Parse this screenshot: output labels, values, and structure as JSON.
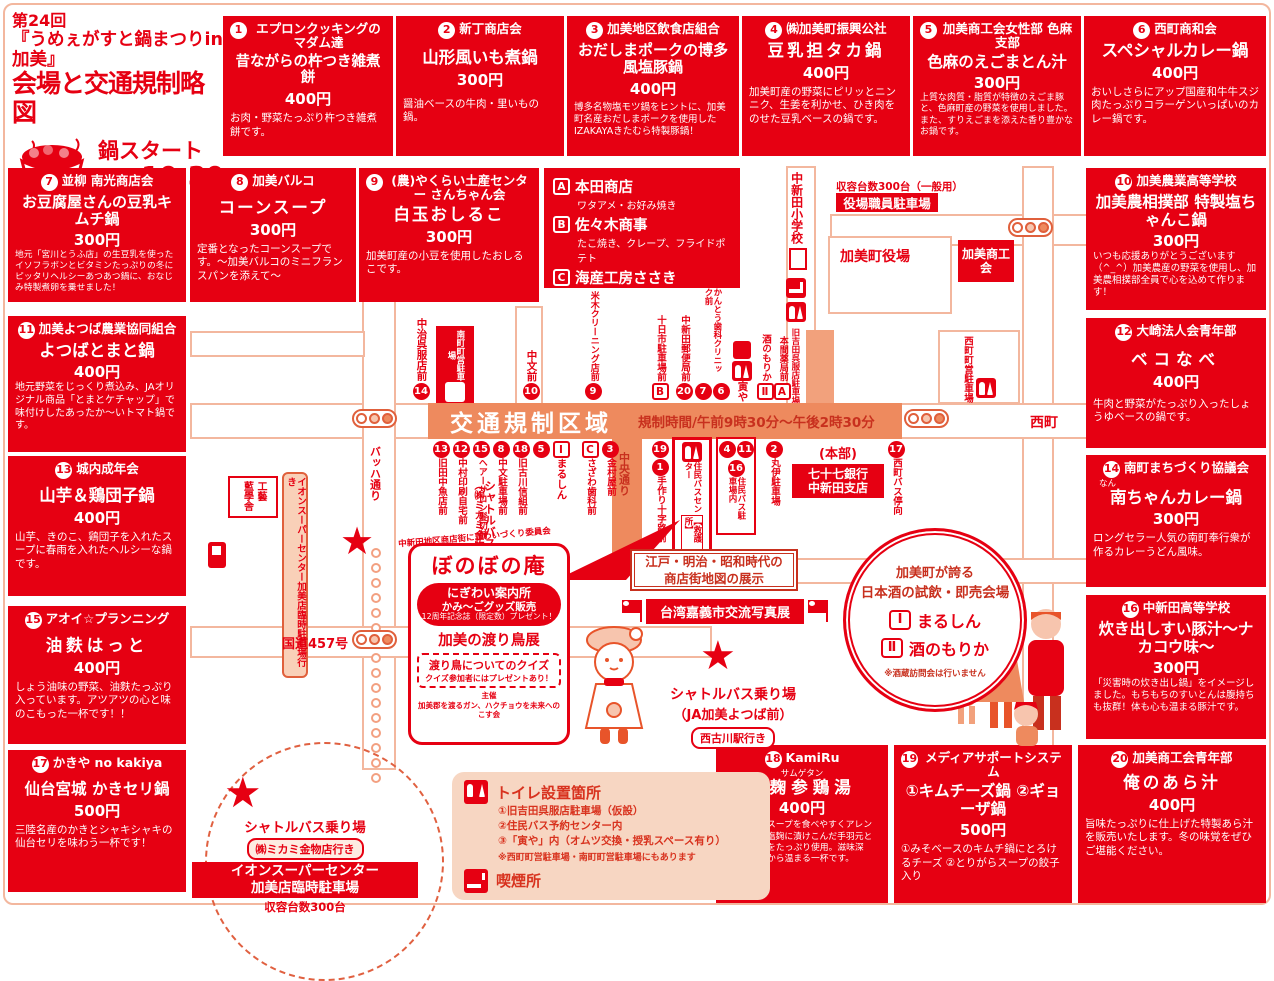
{
  "colors": {
    "red": "#e60012",
    "salmon": "#ee8a5e",
    "pink": "#f7d6c2"
  },
  "header": {
    "l1": "第24回",
    "l2": "『うめぇがすと鍋まつりin加美』",
    "l3": "会場と交通規制略図",
    "start_label": "鍋スタート",
    "start_time": "10:30"
  },
  "booths": [
    {
      "no": "1",
      "org": "エプロンクッキングのマダム達",
      "item": "昔ながらの杵つき雑煮餅",
      "price": "400円",
      "desc": "お肉・野菜たっぷり杵つき雑煮餅です。"
    },
    {
      "no": "2",
      "org": "新丁商店会",
      "item": "山形風いも煮鍋",
      "price": "300円",
      "desc": "醤油ベースの牛肉・里いもの鍋。"
    },
    {
      "no": "3",
      "org": "加美地区飲食店組合",
      "item": "おだしまポークの博多風塩豚鍋",
      "price": "400円",
      "desc": "博多名物塩モツ鍋をヒントに、加美町名産おだしまポークを使用したIZAKAYAきたむら特製豚鍋！"
    },
    {
      "no": "4",
      "org": "㈱加美町振興公社",
      "item": "豆乳担タカ鍋",
      "price": "400円",
      "desc": "加美町産の野菜にピリッとニンニク、生姜を利かせ、ひき肉をのせた豆乳ベースの鍋です。"
    },
    {
      "no": "5",
      "org": "加美商工会女性部 色麻支部",
      "item": "色麻のえごまとん汁",
      "price": "300円",
      "desc": "上質な肉質・脂質が特徴のえごま豚と、色麻町産の野菜を使用しました。また、すりえごまを添えた香り豊かなお鍋です。"
    },
    {
      "no": "6",
      "org": "西町商和会",
      "item": "スペシャルカレー鍋",
      "price": "400円",
      "desc": "おいしさらにアップ国産和牛牛スジ肉たっぷりコラーゲンいっぱいのカレー鍋です。"
    },
    {
      "no": "7",
      "org": "並柳 南光商店会",
      "item": "お豆腐屋さんの豆乳キムチ鍋",
      "price": "300円",
      "desc": "地元「宮川とうふ店」の生豆乳を使ったイソフラボンとビタミンたっぷりの冬にピッタリヘルシーあつあつ鍋に、おなじみ特製煮卵を乗せました！"
    },
    {
      "no": "8",
      "org": "加美バルコ",
      "item": "コーンスープ",
      "price": "300円",
      "desc": "定番となったコーンスープです。～加美バルコのミニフランスパンを添えて～"
    },
    {
      "no": "9",
      "org": "(農)やくらい土産センター さんちゃん会",
      "item": "白玉おしるこ",
      "price": "300円",
      "desc": "加美町産の小豆を使用したおしるこです。"
    },
    {
      "no": "10",
      "org": "加美農業高等学校",
      "item": "加美農相撲部 特製塩ちゃんこ鍋",
      "price": "300円",
      "desc": "いつも応援ありがとうございます（^_^）加美農産の野菜を使用し、加美農相撲部全員で心を込めて作ります！"
    },
    {
      "no": "11",
      "org": "加美よつば農業協同組合",
      "item": "よつばとまと鍋",
      "price": "400円",
      "desc": "地元野菜をじっくり煮込み、JAオリジナル商品「とまとケチャップ」で味付けしたあったか～いトマト鍋です。"
    },
    {
      "no": "12",
      "org": "大崎法人会青年部",
      "item": "ベコなべ",
      "price": "400円",
      "desc": "牛肉と野菜がたっぷり入ったしょうゆベースの鍋です。"
    },
    {
      "no": "13",
      "org": "城内成年会",
      "item": "山芋＆鶏団子鍋",
      "price": "400円",
      "desc": "山芋、きのこ、鶏団子を入れたスープに春雨を入れたヘルシーな鍋です。"
    },
    {
      "no": "14",
      "org": "南町まちづくり協議会",
      "item": "南ちゃんカレー鍋",
      "ruby": "なん",
      "price": "300円",
      "desc": "ロングセラー人気の南町奉行衆が作るカレーうどん風味。"
    },
    {
      "no": "15",
      "org": "アオイ☆プランニング",
      "item": "油麩はっと",
      "price": "400円",
      "desc": "しょう油味の野菜、油麩たっぷり入っています。アツアツの心と味のこもった一杯です！！"
    },
    {
      "no": "16",
      "org": "中新田高等学校",
      "item": "炊き出しすい豚汁～ナカコウ味～",
      "price": "300円",
      "desc": "「災害時の炊き出し鍋」をイメージしました。もちもちのすいとんは腹持ちも抜群！体も心も温まる豚汁です。"
    },
    {
      "no": "17",
      "org": "かきや no kakiya",
      "item": "仙台宮城 かきセリ鍋",
      "price": "500円",
      "desc": "三陸名産のかきとシャキシャキの仙台セリを味わう一杯です！"
    },
    {
      "no": "18",
      "org": "KamiRu",
      "item": "塩麹参鶏湯",
      "ruby": "サムゲタン",
      "price": "400円",
      "desc": "韓国の薬膳スープを食べやすくアレンジ。自家製塩麹に漬けこんだ手羽元と地場産野菜をたっぷり使用。滋味深く、体の芯から温まる一杯です。"
    },
    {
      "no": "19",
      "org": "メディアサポートシステム",
      "item": "①キムチーズ鍋 ②ギョーザ鍋",
      "price": "500円",
      "desc": "①みそベースのキムチ鍋にとろけるチーズ ②とりがらスープの餃子入り"
    },
    {
      "no": "20",
      "org": "加美商工会青年部",
      "item": "俺のあら汁",
      "price": "400円",
      "desc": "旨味たっぷりに仕上げた特製あら汁を販売いたします。冬の味覚をぜひご堪能ください。"
    }
  ],
  "stalls_abc": [
    {
      "no": "A",
      "name": "本田商店",
      "desc": "ワタアメ・お好み焼き"
    },
    {
      "no": "B",
      "name": "佐々木商事",
      "desc": "たこ焼き、クレープ、フライドポテト"
    },
    {
      "no": "C",
      "name": "海産工房ささき",
      "desc": "若布・昆布等・海産物・おでん煮"
    }
  ],
  "map": {
    "school": "中新田小学校",
    "office_cap": "収容台数300台（一般用）",
    "office": "役場職員駐車場",
    "town_hall": "加美町役場",
    "shoko": "加美商工会",
    "nishimachi": "西町",
    "reg_zone": "交通規制区域",
    "reg_time": "規制時間/午前9時30分～午後2時30分",
    "bach": "バッハ通り",
    "chuo": "中央通り",
    "route457": "国道457号",
    "minami_pk": "南町町営駐車場",
    "nishi_pk": "西町町営駐車場",
    "yoshida_pk": "旧吉田呉服店駐車場",
    "rescue1": "住民バスセンター",
    "rescue2": "【救護所】",
    "honbu_tag": "(本部)",
    "honbu1": "七十七銀行",
    "honbu2": "中新田支店",
    "kogei1": "工藝",
    "kogei2": "藍學舎",
    "ion_bound": "イオンスーパーセンター加美店臨時駐車場行き",
    "shuttle1a": "シャトルバス乗り場",
    "shuttle1b": "（㈱ミカミ金物店）",
    "north": [
      {
        "m": [
          "14"
        ],
        "label": "中治呉服店前"
      },
      {
        "m": [
          "10"
        ],
        "label": "中文前"
      },
      {
        "m": [
          "9"
        ],
        "label": "米木クリーニング店前"
      },
      {
        "m": [
          "B"
        ],
        "label": "十日市駐車場前"
      },
      {
        "m": [
          "20"
        ],
        "label": "中新田郵便局前"
      },
      {
        "m": [
          "7",
          "6"
        ],
        "label": "かんとう歯科クリニック前"
      },
      {
        "m": [
          "E"
        ],
        "label": "寅や"
      },
      {
        "m": [
          "Ⅱ"
        ],
        "label": "酒のもりか"
      },
      {
        "m": [
          "A"
        ],
        "label": "本間薬局前"
      }
    ],
    "south": [
      {
        "m": [
          "13"
        ],
        "label": "旧田中魚店前"
      },
      {
        "m": [
          "12"
        ],
        "label": "中村印刷自宅前"
      },
      {
        "m": [
          "15"
        ],
        "label": "ヘアーサロン髪切前"
      },
      {
        "m": [
          "8"
        ],
        "label": "中文駐車場前"
      },
      {
        "m": [
          "18"
        ],
        "label": "旧古川信組前"
      },
      {
        "m": [
          "5"
        ],
        "label": ""
      },
      {
        "m": [
          "Ⅰ"
        ],
        "label": "まるしん"
      },
      {
        "m": [
          "C"
        ],
        "label": "さざわ歯科前"
      },
      {
        "m": [
          "3"
        ],
        "label": "金村屋前"
      },
      {
        "m": [
          "19",
          "1"
        ],
        "label": "手作り十字路前"
      },
      {
        "m": [
          "4",
          "11",
          "16"
        ],
        "label": "住民バス駐車場内"
      },
      {
        "m": [
          "2"
        ],
        "label": "丸伊駐車場"
      },
      {
        "m": [
          "17"
        ],
        "label": "西町バス停向"
      }
    ],
    "bb": {
      "com": "中新田地区商店街にぎわいづくり委員会",
      "title": "ぼのぼの庵",
      "annai": "にぎわい案内所",
      "goods": "かみ～ごグッズ販売",
      "present": "12周年記念誌（限定数）プレゼント！",
      "tenji": "加美の渡り鳥展",
      "quiz": "渡り鳥についてのクイズ",
      "quiz2": "クイズ参加者にはプレゼントあり！",
      "shusai": "主催",
      "org": "加美郡を渡るガン、ハクチョウを未来へのこす会"
    },
    "edo1": "江戸・明治・昭和時代の",
    "edo2": "商店街地図の展示",
    "taiwan": "台湾嘉義市交流写真展",
    "sake": {
      "l1": "加美町が誇る",
      "l2": "日本酒の試飲・即売会場",
      "i1": "Ⅰ",
      "n1": "まるしん",
      "i2": "Ⅱ",
      "n2": "酒のもりか",
      "note": "※酒蔵訪問会は行いません"
    },
    "shuttle2": {
      "l1": "シャトルバス乗り場",
      "l2": "（JA加美よつば前）",
      "badge": "西古川駅行き"
    },
    "shuttle3": {
      "l1": "シャトルバス乗り場",
      "badge": "㈱ミカミ金物店行き",
      "box1": "イオンスーパーセンター",
      "box2": "加美店臨時駐車場",
      "cap": "収容台数300台"
    },
    "legend": {
      "title": "トイレ設置箇所",
      "l1": "①旧吉田呉服店駐車場（仮設）",
      "l2": "②住民バス予約センター内",
      "l3": "③「寅や」内（オムツ交換・授乳スペース有り）",
      "note": "※西町町営駐車場・南町町営駐車場にもあります",
      "smoke": "喫煙所"
    }
  }
}
